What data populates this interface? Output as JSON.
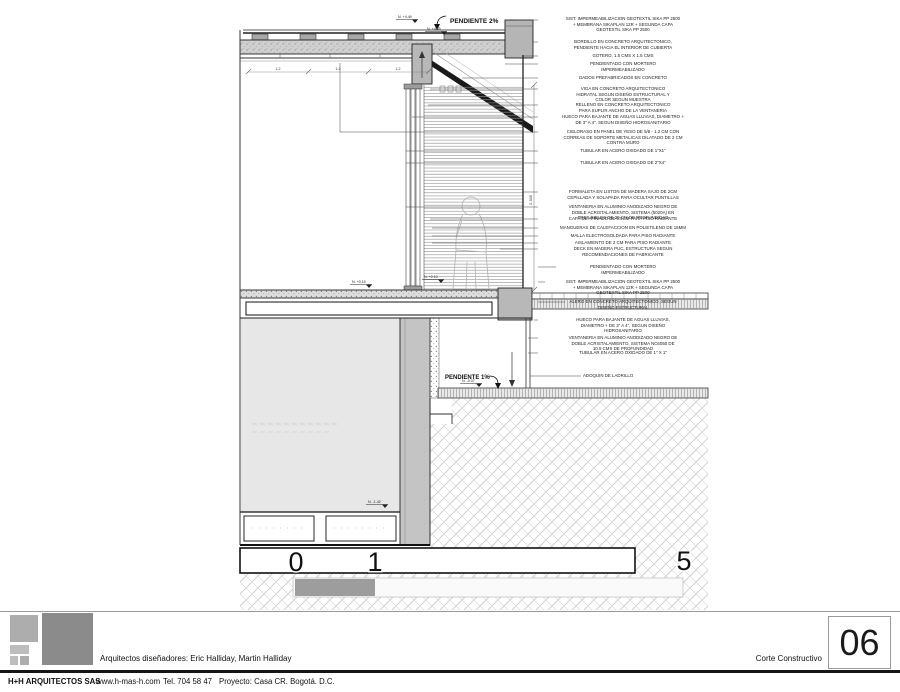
{
  "titleblock": {
    "designers": "Arquitectos diseñadores: Eric Halliday, Martin Halliday",
    "firm": "H+H ARQUITECTOS SAS",
    "website": "www.h-mas-h.com",
    "phone": "Tel. 704 58 47",
    "project": "Proyecto: Casa CR. Bogotá. D.C.",
    "sheet_title": "Corte Constructivo",
    "sheet_number": "06"
  },
  "colors": {
    "logo_light_gray": "#adadad",
    "logo_dark_gray": "#8b8b8b",
    "line_black": "#1a1a1a",
    "concrete_gray": "#c9c9c9",
    "hatch_gray": "#c6c6c6"
  },
  "drawing": {
    "slope_top": "PENDIENTE 2%",
    "slope_bottom": "PENDIENTE 1%",
    "scale": {
      "n0": "0",
      "n1": "1",
      "n5": "5"
    },
    "levels": [
      {
        "label": "N. +4.49"
      },
      {
        "label": "N. +4.45"
      },
      {
        "label": "N. +0.15"
      },
      {
        "label": "N. +0.10"
      },
      {
        "label": "N. -0.07"
      },
      {
        "label": "N. -1.42"
      }
    ],
    "dims": [
      {
        "label": "1.2"
      },
      {
        "label": "1.2"
      },
      {
        "label": "1.2"
      },
      {
        "label": "2.345"
      }
    ]
  },
  "annotations": [
    {
      "text": "SIST. IMPERMEABILIZACION GEOTEXTIL SIKA PP 2500\n+ MEMBRANA SIKAPLAN 12R + SEGUNDA CAPA\nGEOTEXTIL SIKA PP 2500"
    },
    {
      "text": "BORDILLO EN CONCRETO ARQUITECTONICO,\nPENDIENTE HACIA EL INTERIOR DE CUBIERTA"
    },
    {
      "text": "GOTERO, 1.5 CMS X 1.5 CMS"
    },
    {
      "text": "PENDIENTADO CON MORTERO\nIMPERMEABILIZADO"
    },
    {
      "text": "DADOS PREFABRICADOS EN CONCRETO"
    },
    {
      "text": "VIGA EN CONCRETO ARQUITECTONICO\nHIDRATAL SEGUN DISEÑO ESTRUCTURAL Y\nCOLOR SEGUN MUESTRA"
    },
    {
      "text": "RELLENO EN CONCRETO ARQUITECTONICO\nPARA SUPLIR ANCHO DE LA VENTANERIA"
    },
    {
      "text": "HUECO PARA BAJANTE DE AGUAS LLUVIAS, DIAMETRO +\nDE 3\" A 4\", SEGUN DISEÑO HIDROSANITARIO"
    },
    {
      "text": "CIELORASO EN PANEL DE YESO DE 5/8 - 1.2 CM CON\nCORREAS DE SOPORTE METALICAS DILATADO DE 2 CM\nCONTRA MURO"
    },
    {
      "text": "TUBULAR EN ACERO OXIDADO DE 1\"X1\""
    },
    {
      "text": "TUBULAR EN ACERO OXIDADO DE 2\"X4\""
    },
    {
      "text": "FORMALETA EN LISTON DE MADERA SAJO DE 2CM\nCEPILLADA Y SOLAPADA PARA OCULTAR PUNTILLAS"
    },
    {
      "text": "VENTANERIA EN ALUMINIO ANODIZADO NEGRO DE\nDOBLE ACRISTALAMIENTO, SISTEMA (5020A) EN\nTRES RIELES DE 20 CM DE PROFUNDIDAD"
    },
    {
      "text": "CAPA DE AFINADO DE 0.5CM PARA PISO RADIANTE"
    },
    {
      "text": "MANGUERAS DE CALEFACCION EN POLIETILENO DE 16MM"
    },
    {
      "text": "MALLA ELECTROSOLDADA PARA PISO RADIANTE"
    },
    {
      "text": "AISLAMIENTO DE 2 CM PARA PISO RADIANTE"
    },
    {
      "text": "DECK EN MADERA PUC, ESTRUCTURA SEGUN\nRECOMENDACIONES DE FABRICANTE"
    },
    {
      "text": "PENDIENTADO CON MORTERO\nIMPERMEABILIZADO"
    },
    {
      "text": "SIST. IMPERMEABILIZACION GEOTEXTIL SIKA PP 2500\n+ MEMBRANA SIKAPLAN 12R + SEGUNDA CAPA\nGEOTEXTIL SIKA PP 2500"
    },
    {
      "text": "ALERO EN CONCRETO ARQUITECTONICO, SEGUN\nDISEÑO ESTRUCTURAL"
    },
    {
      "text": "HUECO PARA BAJANTE DE AGUAS LLUVIAS,\nDIAMETRO + DE 3\" A 4\", SEGUN DISEÑO\nHIDROSANITARIO"
    },
    {
      "text": "VENTANERIA EN ALUMINIO ANODIZADO NEGRO DE\nDOBLE ACRISTALAMIENTO, SISTEMA NC6050 DE\n10.5 CMS DE PROFUNDIDAD"
    },
    {
      "text": "TUBULAR EN ACERO OXIDADO DE 1\" X 1\""
    },
    {
      "text": "ADOQUIN DE LADRILLO"
    }
  ]
}
